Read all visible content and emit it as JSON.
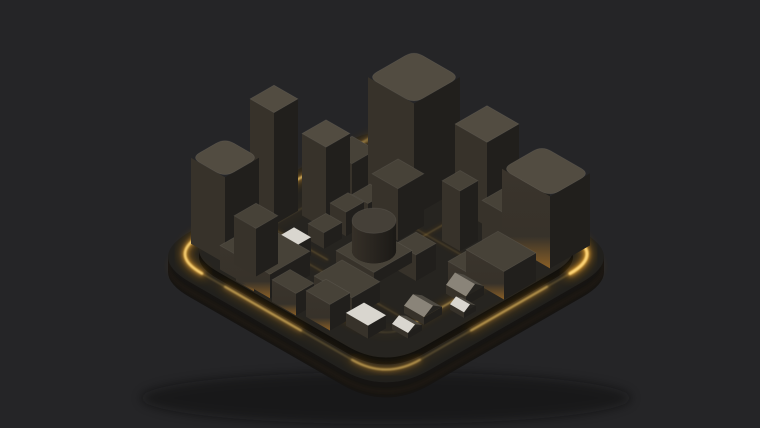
{
  "scene": {
    "description": "Isometric 3D render of a dark miniature city of black block buildings on a rounded-square base plate with glowing amber edge lights and street light strips, on a dark gray background",
    "palette": {
      "background": "#252527",
      "amber_core": "#ffd87a",
      "amber_mid": "#ffb83e",
      "amber": "#f09a18",
      "amber_deep": "#b96e08",
      "face_top": "#474238",
      "face_top_light": "#524c41",
      "face_left": "#37322a",
      "face_right": "#211f1c",
      "lit_left_bottom": "#8a5f26",
      "lit_left_top": "#3a342c",
      "white_roof": "#d9d6cf",
      "gable_light": "#8a8479",
      "gable_mid": "#4e4a42",
      "gable_dark": "#262420",
      "cyl_side_a": "#363028",
      "cyl_side_b": "#1b1916",
      "cyl_top": "#454038",
      "plate_top": "#21201d",
      "plate_side": "#161412",
      "platform_top": "#262420",
      "platform_side": "#100f0d",
      "shadow": "#0a0a0b",
      "edge_highlight": "rgba(255,255,255,0.07)"
    },
    "projection": {
      "cx": 386,
      "cy": 119,
      "sx": 20,
      "sy": 11.5
    },
    "plate": {
      "min": 0,
      "max": 12,
      "corner_radius": 2.2,
      "thickness": 15
    },
    "platform": {
      "inset": 0.85,
      "corner_radius": 1.9,
      "height": 7
    },
    "rings": [
      {
        "name": "outer-glow-ring",
        "min": 0.55,
        "max": 11.45,
        "radius": 1.7,
        "z": 3,
        "base_opacity": 0.2,
        "width": 1.8
      },
      {
        "name": "inner-glow-ring",
        "min": 2.1,
        "max": 9.9,
        "radius": 1.2,
        "z": 7.4,
        "base_opacity": 0.14,
        "width": 1.3
      }
    ],
    "glow_segments": [
      {
        "name": "ne-edge-bright",
        "pts": [
          [
            3.8,
            0.55
          ],
          [
            9.75,
            0.55
          ]
        ],
        "z": 3,
        "w": 3.2,
        "op": 1.0
      },
      {
        "name": "east-corner-arc",
        "pts": [
          [
            9.75,
            0.55
          ],
          [
            11.45,
            0.55
          ],
          [
            11.45,
            2.25
          ]
        ],
        "z": 3,
        "w": 3.0,
        "op": 0.95
      },
      {
        "name": "west-corner-arc",
        "pts": [
          [
            2.25,
            11.45
          ],
          [
            0.55,
            11.45
          ],
          [
            0.55,
            9.75
          ]
        ],
        "z": 3,
        "w": 2.6,
        "op": 0.85
      },
      {
        "name": "nw-edge-mid",
        "pts": [
          [
            0.55,
            4.6
          ],
          [
            0.55,
            8.2
          ]
        ],
        "z": 3,
        "w": 2.2,
        "op": 0.55
      },
      {
        "name": "nw-edge-upper",
        "pts": [
          [
            0.55,
            1.2
          ],
          [
            0.55,
            3.4
          ]
        ],
        "z": 3,
        "w": 2.0,
        "op": 0.3
      },
      {
        "name": "se-edge-mid",
        "pts": [
          [
            11.45,
            3.4
          ],
          [
            11.45,
            7.2
          ]
        ],
        "z": 3,
        "w": 2.0,
        "op": 0.42
      },
      {
        "name": "sw-edge-seg",
        "pts": [
          [
            3.4,
            11.45
          ],
          [
            7.2,
            11.45
          ]
        ],
        "z": 3,
        "w": 2.0,
        "op": 0.45
      },
      {
        "name": "south-corner-arc",
        "pts": [
          [
            9.75,
            11.45
          ],
          [
            11.45,
            11.45
          ],
          [
            11.45,
            9.75
          ]
        ],
        "z": 3,
        "w": 2.0,
        "op": 0.4
      },
      {
        "name": "inner-sw-street",
        "pts": [
          [
            3.2,
            9.9
          ],
          [
            8.6,
            9.9
          ]
        ],
        "z": 7.4,
        "w": 1.6,
        "op": 0.5
      },
      {
        "name": "inner-se-street",
        "pts": [
          [
            9.9,
            4.2
          ],
          [
            9.9,
            8.6
          ]
        ],
        "z": 7.4,
        "w": 1.4,
        "op": 0.4
      }
    ],
    "streets": [
      {
        "name": "center-cross-street",
        "pts": [
          [
            6.35,
            2.2
          ],
          [
            6.35,
            9.6
          ]
        ],
        "z": 7.4,
        "w": 1.1,
        "op": 0.28
      },
      {
        "name": "back-street",
        "pts": [
          [
            2.2,
            4.35
          ],
          [
            9.0,
            4.35
          ]
        ],
        "z": 7.4,
        "w": 1.0,
        "op": 0.22
      },
      {
        "name": "left-street",
        "pts": [
          [
            1.8,
            7.9
          ],
          [
            5.0,
            7.9
          ]
        ],
        "z": 7.4,
        "w": 1.0,
        "op": 0.3
      },
      {
        "name": "mid-front-street",
        "pts": [
          [
            1.6,
            8.55
          ],
          [
            9.2,
            8.55
          ]
        ],
        "z": 7.4,
        "w": 1.0,
        "op": 0.25
      }
    ],
    "buildings": [
      {
        "id": "back-cube",
        "u": 2.8,
        "v": 0.85,
        "w": 1.1,
        "d": 1.1,
        "h": 52
      },
      {
        "id": "main-tower",
        "u": 2.9,
        "v": 1.5,
        "w": 2.3,
        "d": 2.3,
        "h": 112,
        "round": 1
      },
      {
        "id": "right-tower",
        "u": 5.9,
        "v": 0.85,
        "w": 1.6,
        "d": 1.6,
        "h": 84
      },
      {
        "id": "backright-cube",
        "u": 7.8,
        "v": 0.6,
        "w": 1.0,
        "d": 1.0,
        "h": 34
      },
      {
        "id": "right-big-cube",
        "u": 8.5,
        "v": 0.7,
        "w": 2.4,
        "d": 2.0,
        "h": 72,
        "round": 1,
        "lit": 1
      },
      {
        "id": "mid-cube-a",
        "u": 2.2,
        "v": 3.9,
        "w": 1.2,
        "d": 1.2,
        "h": 46
      },
      {
        "id": "mid-cube-b",
        "u": 4.6,
        "v": 4.0,
        "w": 1.3,
        "d": 1.3,
        "h": 52
      },
      {
        "id": "right-mid-cube",
        "u": 8.2,
        "v": 2.4,
        "w": 1.0,
        "d": 1.0,
        "h": 45
      },
      {
        "id": "right-thin-block",
        "u": 7.0,
        "v": 3.3,
        "w": 0.9,
        "d": 0.9,
        "h": 60
      },
      {
        "id": "slender-tower",
        "u": 0.9,
        "v": 6.5,
        "w": 1.2,
        "d": 1.2,
        "h": 112
      },
      {
        "id": "slender-tower-2",
        "u": 2.4,
        "v": 5.4,
        "w": 1.2,
        "d": 1.2,
        "h": 82
      },
      {
        "id": "rounded-tower",
        "u": 0.85,
        "v": 8.9,
        "w": 1.7,
        "d": 1.7,
        "h": 86,
        "round": 1
      },
      {
        "id": "row-house-a",
        "u": 3.6,
        "v": 4.4,
        "w": 0.8,
        "d": 0.9,
        "h": 20
      },
      {
        "id": "row-house-b",
        "u": 3.6,
        "v": 5.5,
        "w": 0.8,
        "d": 0.9,
        "h": 24
      },
      {
        "id": "row-house-c",
        "u": 3.6,
        "v": 6.6,
        "w": 0.8,
        "d": 0.9,
        "h": 16
      },
      {
        "id": "tank-plinth",
        "u": 5.3,
        "v": 5.9,
        "w": 1.9,
        "d": 1.9,
        "h": 12
      },
      {
        "id": "tank-cylinder",
        "shape": "cyl",
        "u": 6.25,
        "v": 6.85,
        "r": 0.78,
        "z": 12,
        "h": 30,
        "bias": 1.5
      },
      {
        "id": "left-block",
        "u": 2.7,
        "v": 9.0,
        "w": 2.5,
        "d": 2.0,
        "h": 24,
        "lit": 1
      },
      {
        "id": "left-block-tower",
        "u": 2.8,
        "v": 9.3,
        "w": 1.1,
        "d": 1.1,
        "h": 48,
        "bias": 2.5
      },
      {
        "id": "white-top-box",
        "u": 3.5,
        "v": 8.1,
        "w": 0.85,
        "d": 0.85,
        "h": 18,
        "roof": "white"
      },
      {
        "id": "mid-right-low",
        "u": 7.1,
        "v": 5.6,
        "w": 1.0,
        "d": 1.0,
        "h": 26
      },
      {
        "id": "front-center-low",
        "u": 6.2,
        "v": 8.4,
        "w": 1.9,
        "d": 1.4,
        "h": 20
      },
      {
        "id": "right-low-wide",
        "u": 9.2,
        "v": 3.6,
        "w": 1.9,
        "d": 1.6,
        "h": 28,
        "lit": 1
      },
      {
        "id": "right-small-cube",
        "u": 9.0,
        "v": 4.9,
        "w": 1.0,
        "d": 1.0,
        "h": 22,
        "lit": 1
      },
      {
        "id": "house-a",
        "shape": "gable",
        "u": 9.2,
        "v": 7.4,
        "w": 1.0,
        "d": 0.9,
        "h": 14
      },
      {
        "id": "house-b",
        "shape": "gable",
        "u": 9.4,
        "v": 5.5,
        "w": 1.0,
        "d": 0.9,
        "h": 16
      },
      {
        "id": "house-white",
        "shape": "gable",
        "u": 10.2,
        "v": 6.4,
        "w": 0.7,
        "d": 0.6,
        "h": 10,
        "roof": "white"
      },
      {
        "id": "front-white-roof",
        "u": 8.3,
        "v": 9.4,
        "w": 1.1,
        "d": 0.9,
        "h": 13,
        "roof": "white"
      },
      {
        "id": "front-white-gable",
        "shape": "gable",
        "u": 9.6,
        "v": 8.6,
        "w": 0.8,
        "d": 0.7,
        "h": 10,
        "roof": "white"
      },
      {
        "id": "front-cube-a",
        "u": 3.6,
        "v": 10.4,
        "w": 0.9,
        "d": 0.7,
        "h": 14,
        "lit": 1
      },
      {
        "id": "front-cube-b",
        "u": 5.4,
        "v": 10.2,
        "w": 1.2,
        "d": 0.9,
        "h": 22,
        "lit": 1
      },
      {
        "id": "front-cube-c",
        "u": 6.9,
        "v": 9.9,
        "w": 1.2,
        "d": 1.0,
        "h": 26,
        "lit": 1
      }
    ]
  }
}
